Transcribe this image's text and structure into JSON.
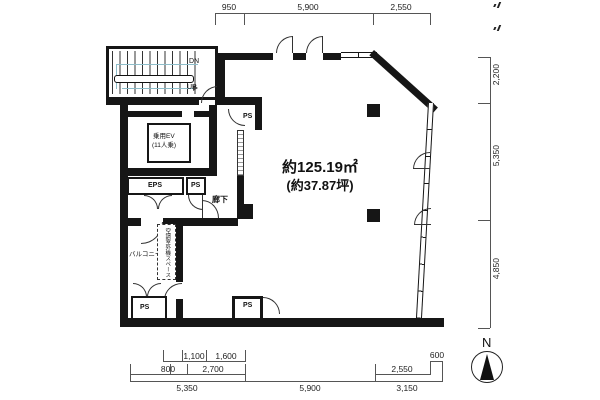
{
  "labels": {
    "area_m2": "約125.19㎡",
    "area_tsubo": "(約37.87坪)",
    "stairs_dn": "DN",
    "stairs_up": "UP",
    "elevator_line1": "乗用EV",
    "elevator_line2": "(11人乗)",
    "eps": "EPS",
    "ps": "PS",
    "corridor": "廊下",
    "balcony": "バルコニー",
    "ac_outdoor_space": "空調室外機スペース",
    "north": "N"
  },
  "dimensions": {
    "top": [
      "950",
      "5,900",
      "2,550"
    ],
    "right": [
      "2,200",
      "5,350",
      "4,850"
    ],
    "bottom_upper": [
      "1,100",
      "1,600",
      "600"
    ],
    "bottom_middle": [
      "800",
      "2,700",
      "2,550"
    ],
    "bottom_lower": [
      "5,350",
      "5,900",
      "3,150"
    ]
  }
}
